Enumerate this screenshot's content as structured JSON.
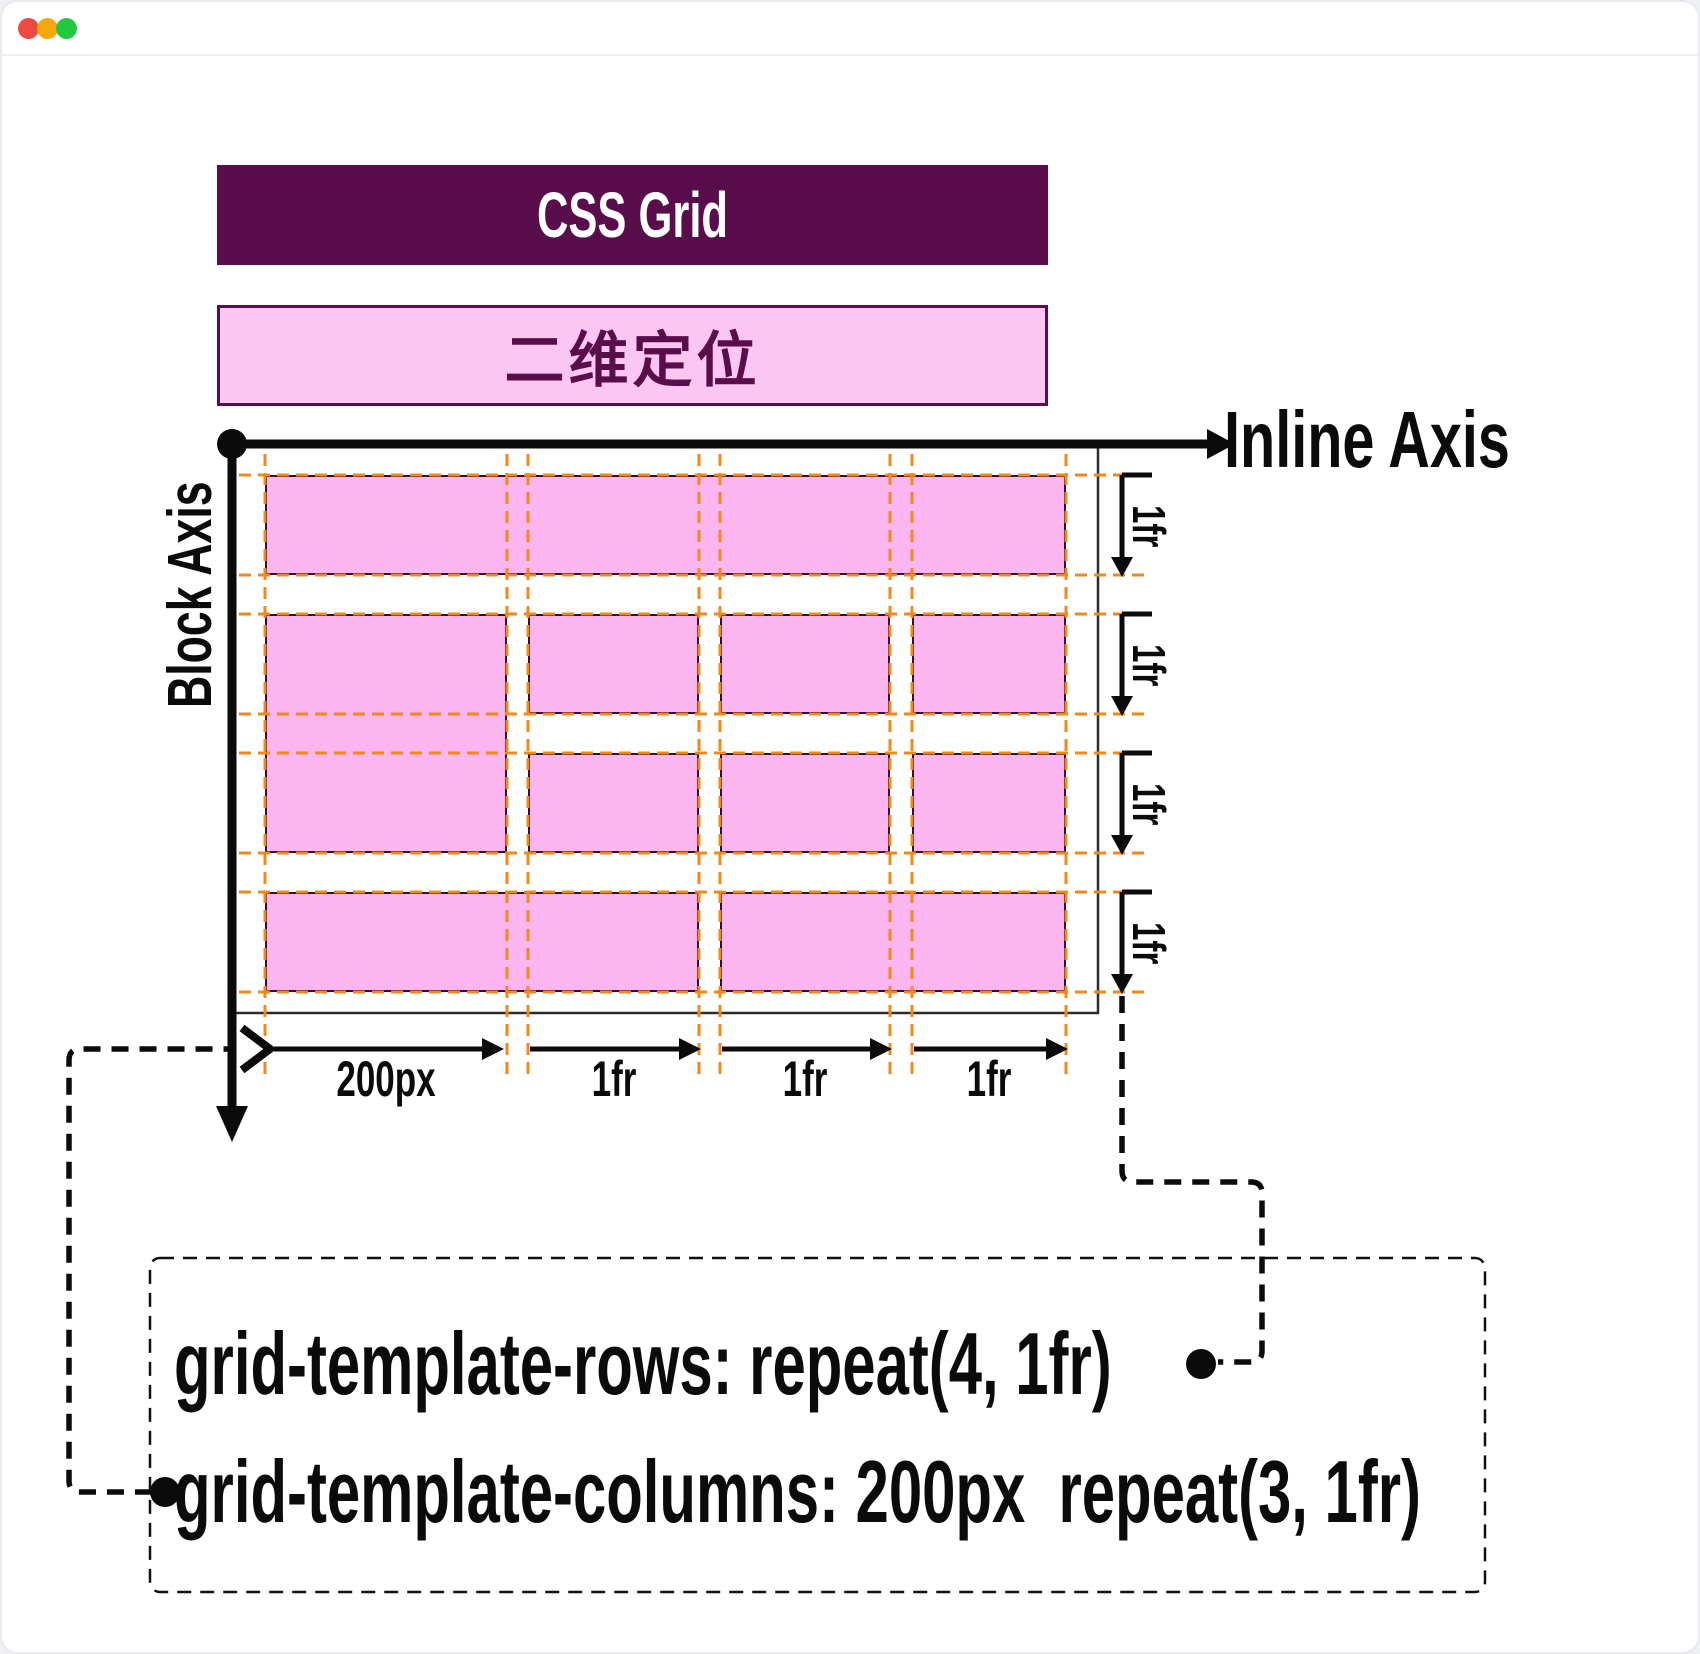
{
  "window": {
    "controls": [
      {
        "name": "close",
        "color": "#ed4b40"
      },
      {
        "name": "minimize",
        "color": "#f7a60d"
      },
      {
        "name": "zoom",
        "color": "#23c840"
      }
    ]
  },
  "header": {
    "title": "CSS Grid",
    "subtitle": "二维定位"
  },
  "axes": {
    "inline_label": "Inline Axis",
    "block_label": "Block Axis"
  },
  "tracks": {
    "row_labels": [
      "1fr",
      "1fr",
      "1fr",
      "1fr"
    ],
    "column_labels": [
      "200px",
      "1fr",
      "1fr",
      "1fr"
    ]
  },
  "code": {
    "rows_line": "grid-template-rows: repeat(4, 1fr)",
    "columns_line": "grid-template-columns: 200px  repeat(3, 1fr)"
  },
  "colors": {
    "accent_purple": "#5a0d4b",
    "item_pink": "#fbb5ef",
    "banner_pink": "#fcc6f3",
    "gridline_orange": "#f0881c",
    "line_black": "#0b0b0b"
  }
}
